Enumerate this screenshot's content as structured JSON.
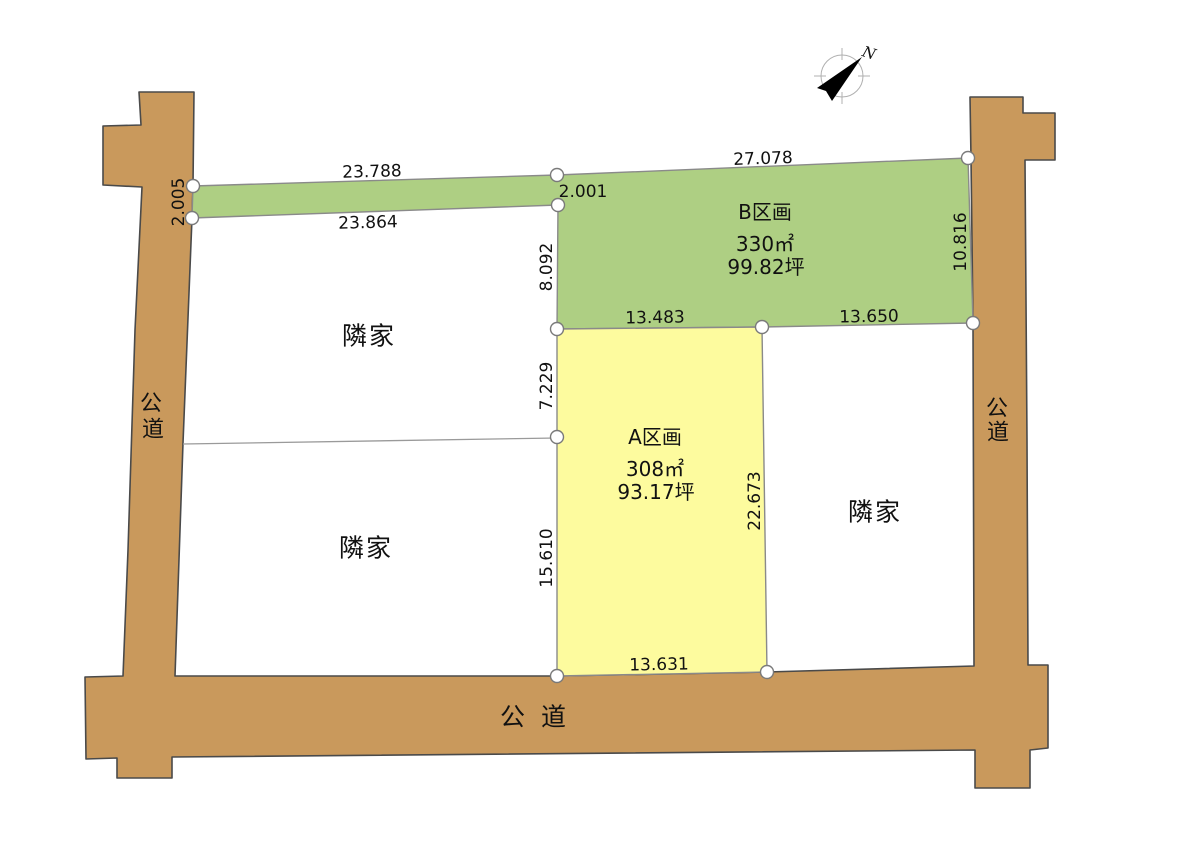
{
  "diagram_title": "land-subdivision-plot-map",
  "colors": {
    "road_fill": "#c9995c",
    "road_stroke": "#4a4a4a",
    "plot_b_fill": "#aecf83",
    "plot_a_fill": "#fdfb9e",
    "plot_stroke": "#8a8a8a",
    "text": "#111111"
  },
  "north": {
    "label": "N"
  },
  "roads": {
    "left_label_chars": [
      "公",
      "道"
    ],
    "right_label_chars": [
      "公",
      "道"
    ],
    "bottom_label": "公 道"
  },
  "plots": {
    "b": {
      "name": "B区画",
      "area_m2": "330㎡",
      "area_tsubo": "99.82坪"
    },
    "a": {
      "name": "A区画",
      "area_m2": "308㎡",
      "area_tsubo": "93.17坪"
    },
    "neighbors": [
      "隣家",
      "隣家",
      "隣家"
    ]
  },
  "dims": {
    "strip_top": "23.788",
    "strip_bottom": "23.864",
    "strip_road_width": "2.005",
    "strip_inner_width": "2.001",
    "b_top": "27.078",
    "b_left": "8.092",
    "b_right": "10.816",
    "b_bottom_left": "13.483",
    "b_bottom_right": "13.650",
    "a_left_upper": "7.229",
    "a_left_lower": "15.610",
    "a_right": "22.673",
    "a_bottom": "13.631"
  }
}
